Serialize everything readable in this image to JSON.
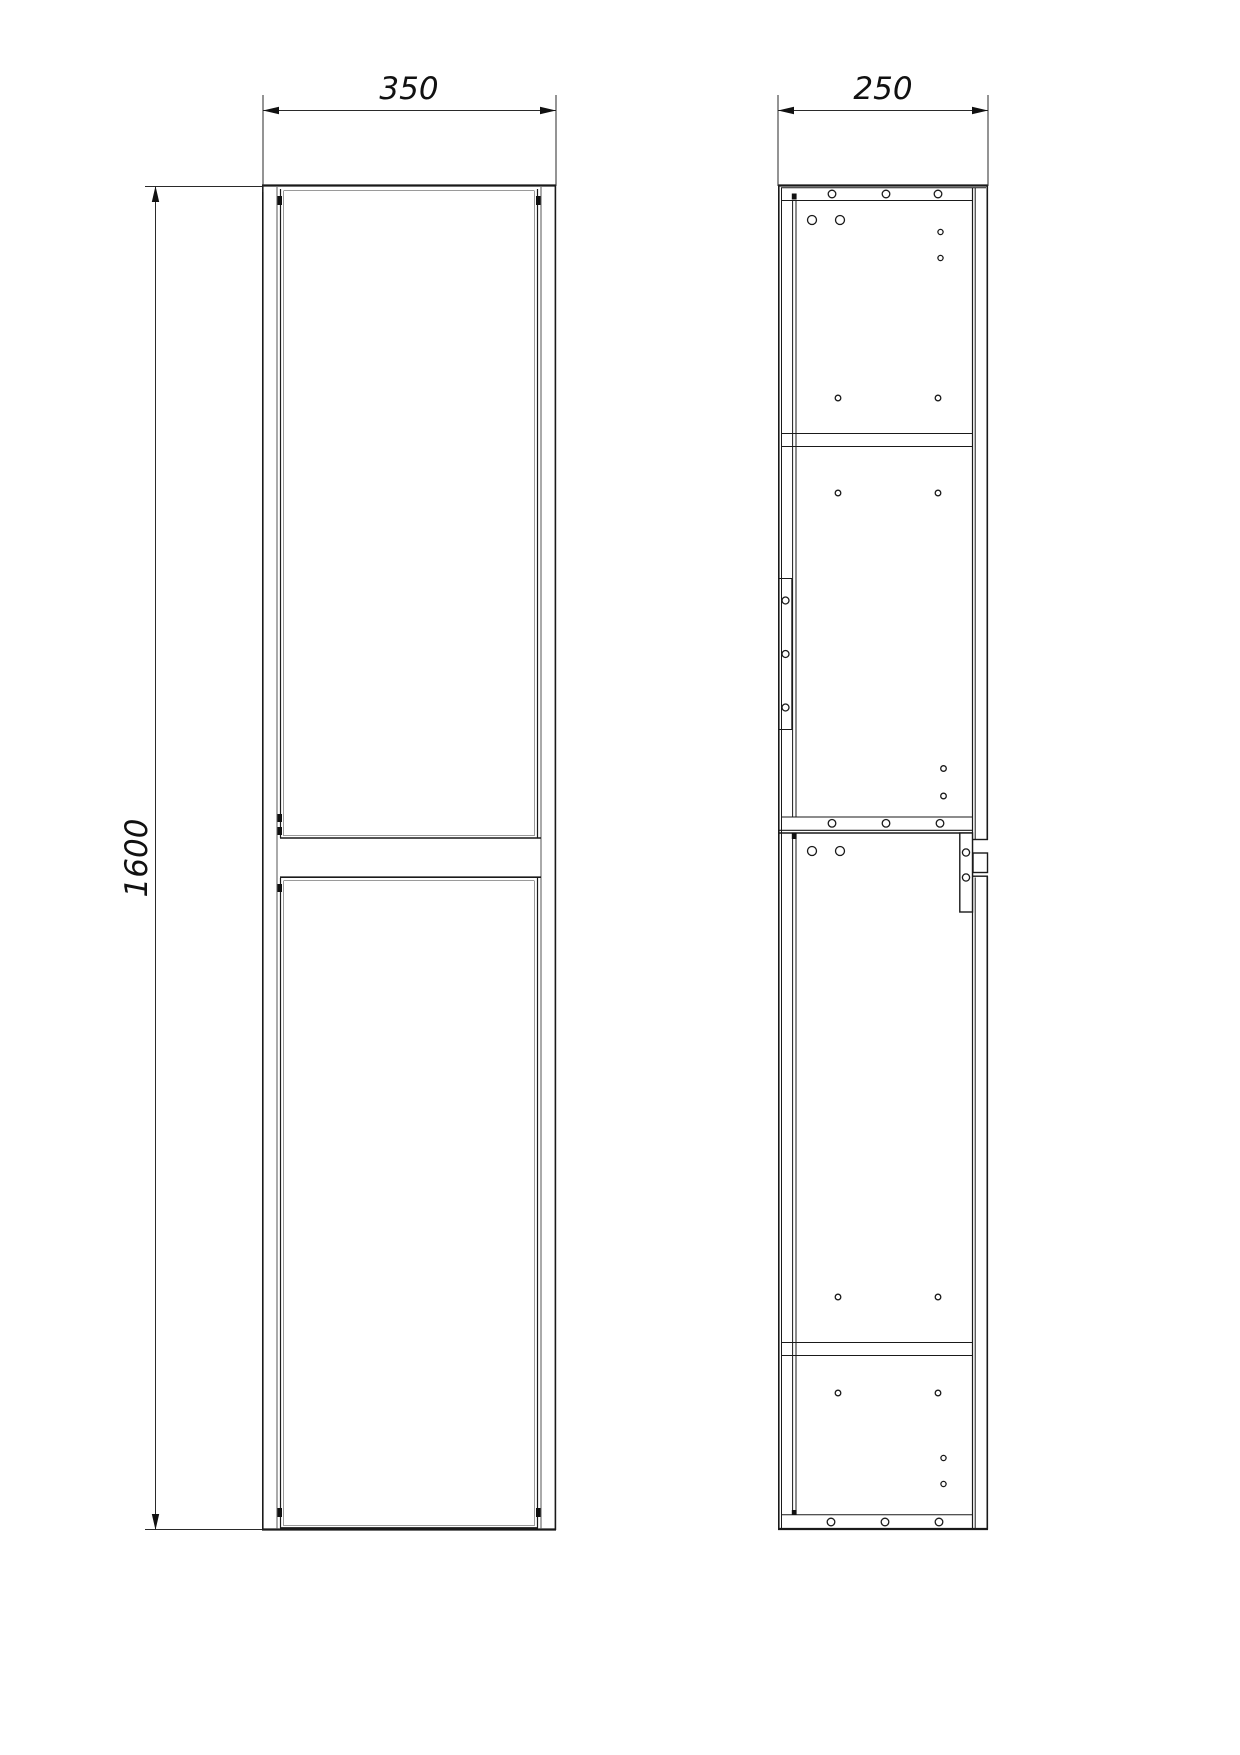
{
  "page": {
    "background": "#ffffff"
  },
  "drawing": {
    "type": "furniture-technical-drawing",
    "description": "Tall two-door cabinet, front elevation and side section",
    "line_color": "#1a1a1a",
    "shadow_line_color": "#9a9a9a",
    "views": [
      {
        "id": "front-view",
        "parts": [
          "carcass",
          "upper-door",
          "lower-door",
          "hinge-marks"
        ]
      },
      {
        "id": "side-view",
        "parts": [
          "carcass",
          "top-panel",
          "shelf",
          "module-joint",
          "bottom-panel",
          "back-panel",
          "hanging-plate",
          "door-edge",
          "connector-bracket",
          "drill-holes"
        ]
      }
    ],
    "dimensions": [
      {
        "id": "front-width",
        "label": "350"
      },
      {
        "id": "front-height",
        "label": "1600"
      },
      {
        "id": "side-depth",
        "label": "250"
      }
    ]
  }
}
